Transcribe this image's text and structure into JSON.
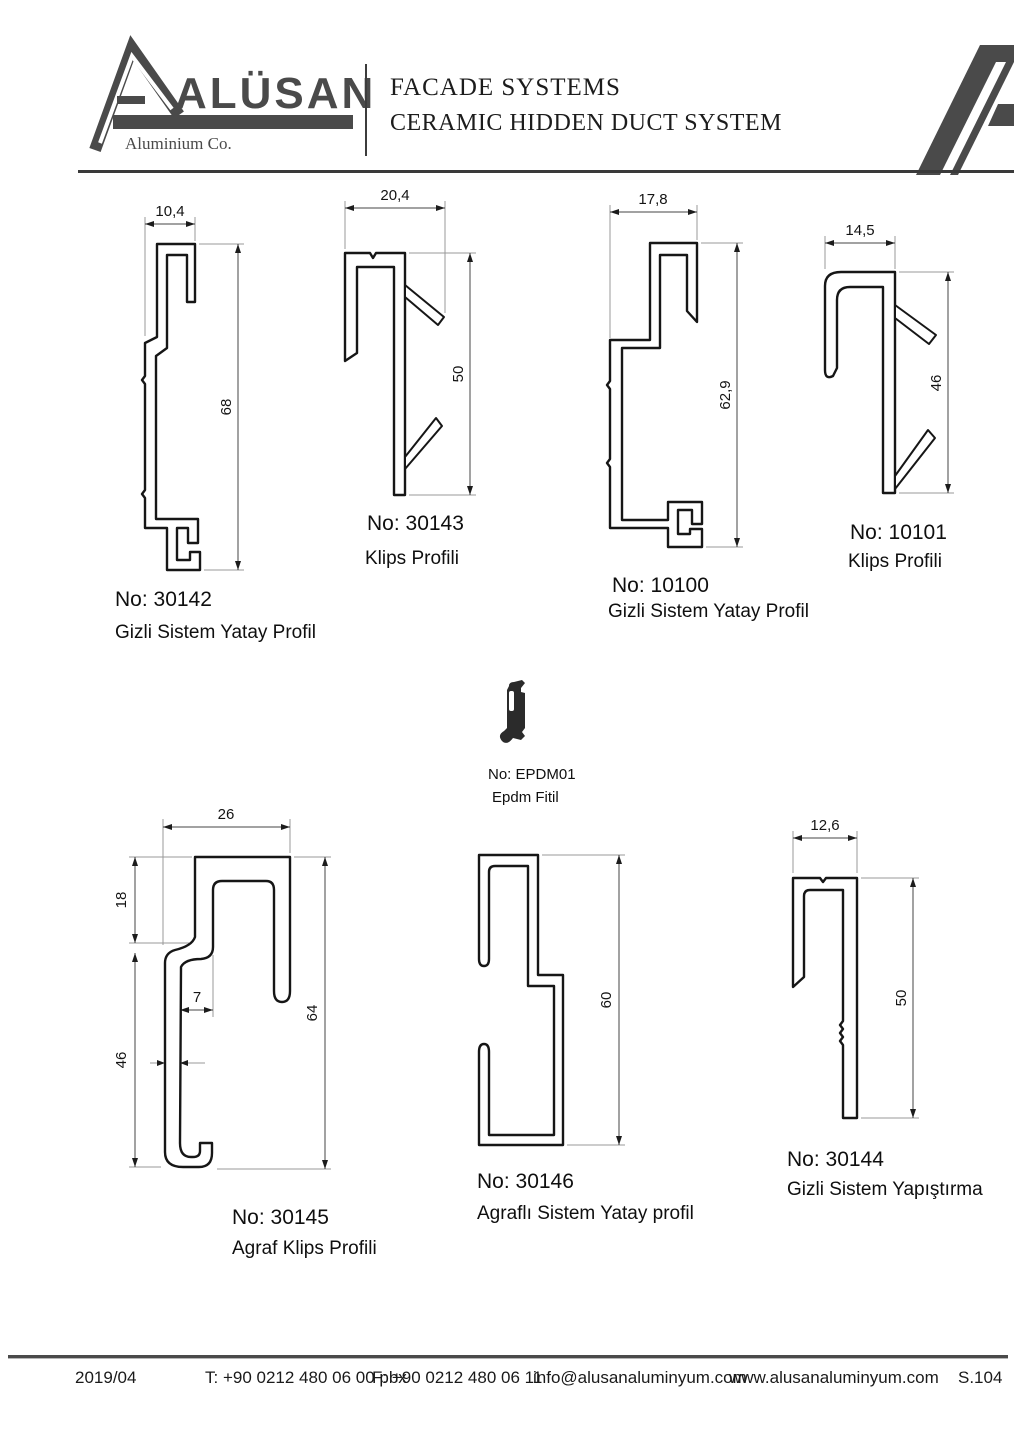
{
  "header": {
    "brand": "ALÜSAN",
    "brand_subtitle": "Aluminium Co.",
    "title_line1": "FACADE SYSTEMS",
    "title_line2": "CERAMIC HIDDEN DUCT SYSTEM"
  },
  "colors": {
    "logo_gray": "#4a4a4a",
    "line_black": "#161616"
  },
  "profiles": [
    {
      "no_label": "No: 30142",
      "name": "Gizli Sistem Yatay Profil",
      "width": "10,4",
      "height": "68"
    },
    {
      "no_label": "No: 30143",
      "name": "Klips Profili",
      "width": "20,4",
      "height": "50"
    },
    {
      "no_label": "No: 10100",
      "name": "Gizli Sistem Yatay Profil",
      "width": "17,8",
      "height": "62,9"
    },
    {
      "no_label": "No: 10101",
      "name": "Klips Profili",
      "width": "14,5",
      "height": "46"
    },
    {
      "no_label": "No: EPDM01",
      "name": "Epdm Fitil"
    },
    {
      "no_label": "No: 30145",
      "name": "Agraf Klips Profili",
      "width": "26",
      "height": "64",
      "dim_top": "18",
      "dim_bottom": "46",
      "dim_pocket": "7",
      "dim_wall": "3"
    },
    {
      "no_label": "No: 30146",
      "name": "Agraflı Sistem Yatay profil",
      "height": "60"
    },
    {
      "no_label": "No: 30144",
      "name": "Gizli Sistem Yapıştırma",
      "width": "12,6",
      "height": "50"
    }
  ],
  "footer": {
    "date": "2019/04",
    "phone": "T: +90 0212 480 06 00 pbx",
    "fax": "F: +90 0212 480 06 11",
    "email": "info@alusanaluminyum.com",
    "website": "www.alusanaluminyum.com",
    "page": "S.104"
  }
}
